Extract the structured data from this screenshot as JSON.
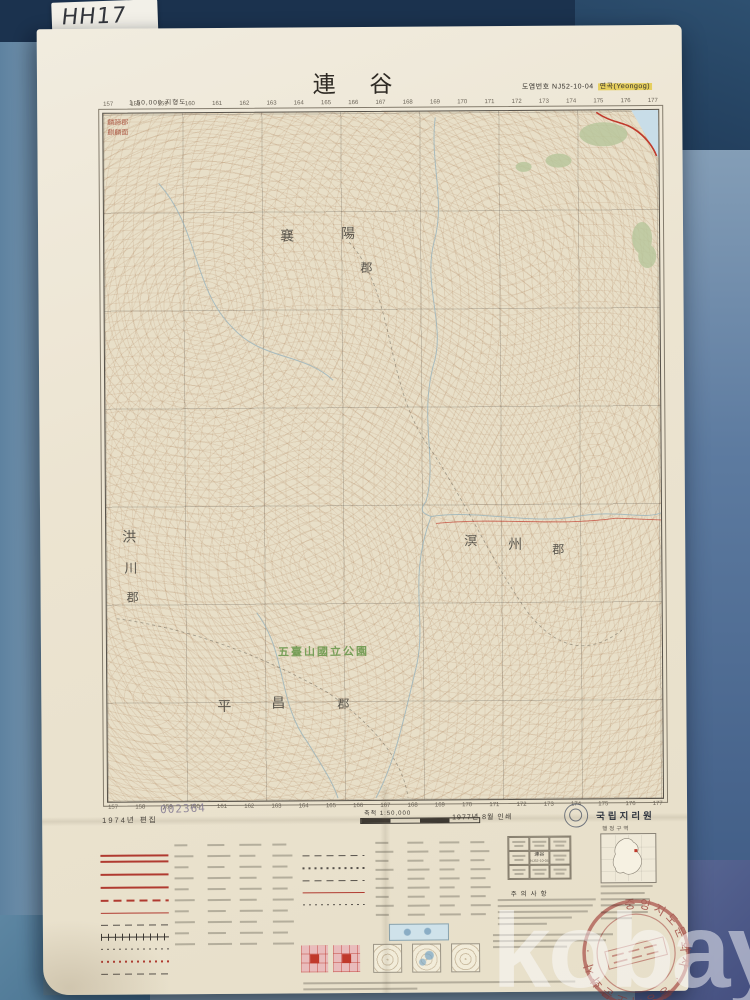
{
  "photo": {
    "tab_label": "HH17",
    "watermark": "kobay"
  },
  "header": {
    "title": "連 谷",
    "scale_note": "1:50,000 지형도",
    "sheet_no_label": "도엽번호 NJ52-10-04",
    "sheet_name": "연곡(Yeongog)"
  },
  "map": {
    "grid_numbers": [
      "157",
      "158",
      "159",
      "160",
      "161",
      "162",
      "163",
      "164",
      "165",
      "166",
      "167",
      "168",
      "169",
      "170",
      "171",
      "172",
      "173",
      "174",
      "175",
      "176",
      "177"
    ],
    "park_label": "五臺山國立公園",
    "districts": [
      {
        "t": "麟蹄郡",
        "x": 4,
        "y": 6,
        "s": 7,
        "c": "#a84f3c"
      },
      {
        "t": "麒麟面",
        "x": 4,
        "y": 16,
        "s": 7,
        "c": "#a84f3c"
      },
      {
        "t": "襄",
        "x": 176,
        "y": 118,
        "s": 14,
        "c": "#43403a"
      },
      {
        "t": "陽",
        "x": 237,
        "y": 116,
        "s": 14,
        "c": "#43403a"
      },
      {
        "t": "郡",
        "x": 256,
        "y": 150,
        "s": 12,
        "c": "#43403a"
      },
      {
        "t": "洪",
        "x": 16,
        "y": 418,
        "s": 14,
        "c": "#43403a"
      },
      {
        "t": "川",
        "x": 18,
        "y": 448,
        "s": 13,
        "c": "#43403a"
      },
      {
        "t": "郡",
        "x": 20,
        "y": 478,
        "s": 12,
        "c": "#43403a"
      },
      {
        "t": "溟",
        "x": 358,
        "y": 423,
        "s": 13,
        "c": "#43403a"
      },
      {
        "t": "州",
        "x": 402,
        "y": 428,
        "s": 14,
        "c": "#43403a"
      },
      {
        "t": "郡",
        "x": 446,
        "y": 433,
        "s": 12,
        "c": "#43403a"
      },
      {
        "t": "平",
        "x": 110,
        "y": 588,
        "s": 14,
        "c": "#43403a"
      },
      {
        "t": "昌",
        "x": 164,
        "y": 585,
        "s": 14,
        "c": "#43403a"
      },
      {
        "t": "郡",
        "x": 230,
        "y": 586,
        "s": 12,
        "c": "#43403a"
      }
    ]
  },
  "imprint": {
    "edition": "1974년 편집",
    "serial": "002364",
    "scale_label": "축척 1:50,000",
    "printed": "1977년 8월 인쇄",
    "agency": "국립지리원",
    "index_caption": "행정구역"
  },
  "legend": {
    "notes_heading": "주의사항",
    "adjacent_center": "連谷",
    "adjacent_center_no": "NJ52-10-04"
  },
  "stamp": {
    "ring_text": "중앙지도문화사 · 중앙지도문화사 ·"
  },
  "colors": {
    "road_red": "#c0392b",
    "park_green": "#6f9a50",
    "highlight_yellow": "#e6cf5f",
    "stamp_red": "#b85c5c",
    "sea_blue": "#c8dde8",
    "sheet_cream": "#ebe4d2"
  }
}
